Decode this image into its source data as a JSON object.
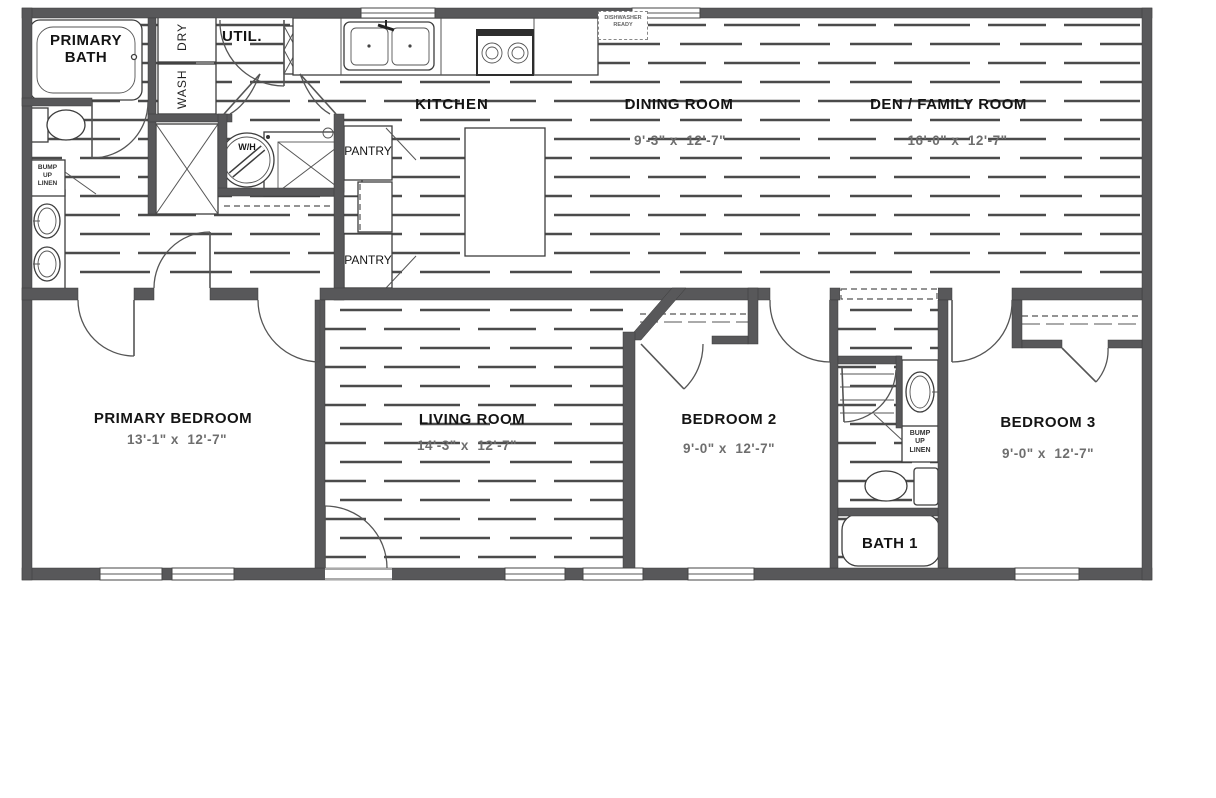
{
  "plan": {
    "rooms": {
      "primary_bath": {
        "name": "PRIMARY BATH"
      },
      "util": {
        "name": "UTIL."
      },
      "kitchen": {
        "name": "KITCHEN"
      },
      "dining": {
        "name": "DINING ROOM",
        "dims": "9'-3\" x  12'-7\""
      },
      "den": {
        "name": "DEN / FAMILY ROOM",
        "dims": "16'-0\" x  12'-7\""
      },
      "primary_bedroom": {
        "name": "PRIMARY BEDROOM",
        "dims": "13'-1\" x  12'-7\""
      },
      "living": {
        "name": "LIVING ROOM",
        "dims": "14'-3\" x  12'-7\""
      },
      "bedroom2": {
        "name": "BEDROOM 2",
        "dims": "9'-0\" x  12'-7\""
      },
      "bedroom3": {
        "name": "BEDROOM 3",
        "dims": "9'-0\" x  12'-7\""
      },
      "bath1": {
        "name": "BATH 1"
      }
    },
    "fixtures": {
      "dry": "DRY",
      "wash": "WASH",
      "water_heater": "W/H",
      "pantry1": "PANTRY",
      "pantry2": "PANTRY",
      "linen_left": {
        "l1": "BUMP",
        "l2": "UP",
        "l3": "LINEN"
      },
      "linen_bath": {
        "l1": "BUMP",
        "l2": "UP",
        "l3": "LINEN"
      },
      "dw_ready": {
        "l1": "DISHWASHER",
        "l2": "READY"
      }
    },
    "colors": {
      "wall": "#58585a",
      "hatch": "#4b4b4b",
      "dim_text": "#6e6e6e",
      "label_text": "#141414"
    }
  }
}
